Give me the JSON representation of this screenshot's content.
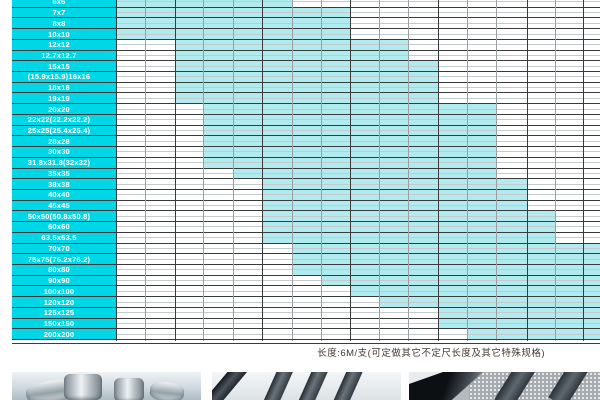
{
  "colors": {
    "label_cyan": "#00d7e6",
    "fill_cyan": "#b0ebf0",
    "grid_dark": "#3b3b3b",
    "grid_light": "#9aa0a2",
    "row_mid_line": "#c3cbcd",
    "note_text": "#453931"
  },
  "chart_data": {
    "type": "table",
    "description": "Square steel tube size availability matrix: cyan band marks available wall-thickness columns per size row; header row cut off above screenshot",
    "rows": [
      {
        "label": "6x6",
        "fill_start_col": 0,
        "fill_end_col": 6
      },
      {
        "label": "7x7",
        "fill_start_col": 0,
        "fill_end_col": 8
      },
      {
        "label": "8x8",
        "fill_start_col": 0,
        "fill_end_col": 8
      },
      {
        "label": "10x10",
        "fill_start_col": 0,
        "fill_end_col": 8
      },
      {
        "label": "12x12",
        "fill_start_col": 2,
        "fill_end_col": 10
      },
      {
        "label": "12.7x12.7",
        "fill_start_col": 2,
        "fill_end_col": 10
      },
      {
        "label": "15x15",
        "fill_start_col": 2,
        "fill_end_col": 11
      },
      {
        "label": "(15.9x15.9)16x16",
        "fill_start_col": 2,
        "fill_end_col": 11
      },
      {
        "label": "18x18",
        "fill_start_col": 2,
        "fill_end_col": 11
      },
      {
        "label": "19x19",
        "fill_start_col": 2,
        "fill_end_col": 11
      },
      {
        "label": "20x20",
        "fill_start_col": 3,
        "fill_end_col": 13
      },
      {
        "label": "22x22(22.2x22.2)",
        "fill_start_col": 3,
        "fill_end_col": 13
      },
      {
        "label": "25x25(25.4x25.4)",
        "fill_start_col": 3,
        "fill_end_col": 13
      },
      {
        "label": "28x28",
        "fill_start_col": 3,
        "fill_end_col": 13
      },
      {
        "label": "30x30",
        "fill_start_col": 3,
        "fill_end_col": 13
      },
      {
        "label": "31.8x31.8(32x32)",
        "fill_start_col": 3,
        "fill_end_col": 13
      },
      {
        "label": "35x35",
        "fill_start_col": 4,
        "fill_end_col": 13
      },
      {
        "label": "38x38",
        "fill_start_col": 5,
        "fill_end_col": 14
      },
      {
        "label": "40x40",
        "fill_start_col": 5,
        "fill_end_col": 14
      },
      {
        "label": "45x45",
        "fill_start_col": 5,
        "fill_end_col": 14
      },
      {
        "label": "50x50(50.8x50.8)",
        "fill_start_col": 5,
        "fill_end_col": 15
      },
      {
        "label": "60x60",
        "fill_start_col": 5,
        "fill_end_col": 15
      },
      {
        "label": "63.5x63.5",
        "fill_start_col": 5,
        "fill_end_col": 15
      },
      {
        "label": "70x70",
        "fill_start_col": 6,
        "fill_end_col": 17
      },
      {
        "label": "75x75(76.2x76.2)",
        "fill_start_col": 6,
        "fill_end_col": 17
      },
      {
        "label": "80x80",
        "fill_start_col": 6,
        "fill_end_col": 17
      },
      {
        "label": "90x90",
        "fill_start_col": 7,
        "fill_end_col": 17
      },
      {
        "label": "100x100",
        "fill_start_col": 8,
        "fill_end_col": 17
      },
      {
        "label": "120x120",
        "fill_start_col": 9,
        "fill_end_col": 17
      },
      {
        "label": "125x125",
        "fill_start_col": 11,
        "fill_end_col": 17
      },
      {
        "label": "150x150",
        "fill_start_col": 11,
        "fill_end_col": 17
      },
      {
        "label": "200x200",
        "fill_start_col": 12,
        "fill_end_col": 17
      }
    ],
    "layout": {
      "left_margin": 12,
      "label_col_right": 116,
      "col_x": [
        116,
        145,
        175,
        203,
        233,
        262,
        292,
        321,
        350,
        379,
        408,
        438,
        467,
        496,
        527,
        555,
        583,
        600
      ],
      "major_col_lines": [
        116,
        175,
        262,
        350,
        438,
        527,
        583
      ],
      "row_height": 10.72,
      "top_offset": -4,
      "grid": "on"
    }
  },
  "note": {
    "text": "长度:6M/支(可定做其它不定尺长度及其它特殊规格)"
  },
  "photos": [
    {
      "name": "round-steel-bars-photo"
    },
    {
      "name": "flat-steel-bars-photo"
    },
    {
      "name": "angle-steel-blocks-photo"
    }
  ]
}
